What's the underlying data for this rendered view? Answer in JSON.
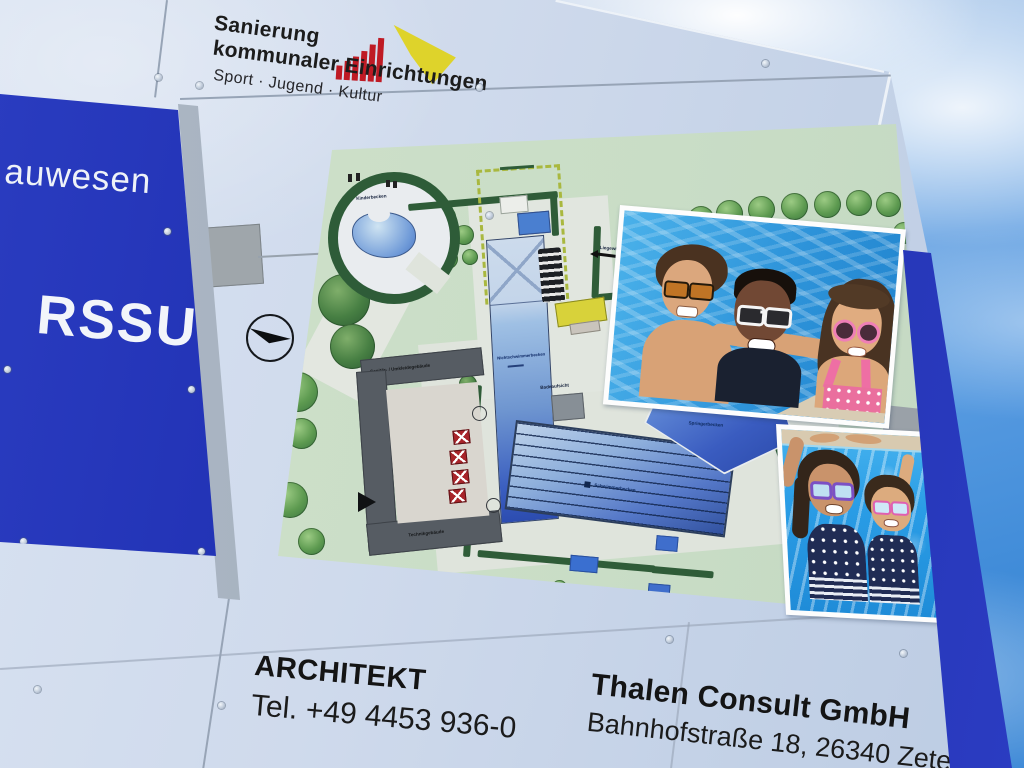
{
  "billboard": {
    "program": {
      "title_line1": "Sanierung",
      "title_line2": "kommunaler Einrichtungen",
      "subtitle": "Sport · Jugend · Kultur"
    },
    "architect": {
      "heading": "ARCHITEKT",
      "phone": "Tel. +49 4453 936-0"
    },
    "planner": {
      "name": "Thalen Consult GmbH",
      "address": "Bahnhofstraße 18, 26340 Zetel"
    }
  },
  "side_sign": {
    "top_text": "auwesen",
    "main_text": "RSSUM"
  },
  "site_plan": {
    "labels": {
      "kinderbecken": "Kinderbecken",
      "nichtschwimmerbecken": "Nichtschwimmerbecken",
      "schwimmerbecken": "Schwimmerbecken",
      "springerbecken": "Springerbecken",
      "sanitaergebaeude": "Sanitär- / Umkleidegebäude",
      "technikgebaeude": "Technikgebäude",
      "badeaufsicht": "Badeaufsicht",
      "liegewiese": "Liegewiese"
    }
  },
  "colors": {
    "sign_blue": "#1c2cae",
    "edge_band_blue": "#1e2ea8",
    "board_white": "#cfdaec",
    "plan_green": "#cde0ca",
    "hedge_green": "#2f5c38",
    "pool_blue": "#3358b8",
    "logo_red": "#bf1a24",
    "logo_yellow": "#ded32b",
    "sky_blue": "#4490dc"
  }
}
